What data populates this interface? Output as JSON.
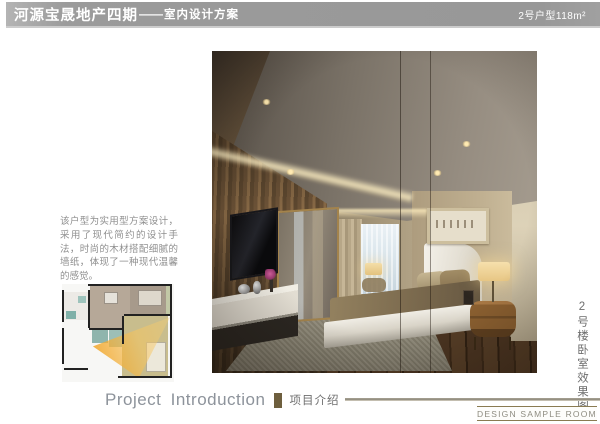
{
  "header": {
    "project_title": "河源宝晟地产四期",
    "divider": "——",
    "doc_type": "室内设计方案",
    "unit_label": "2号户型118m²"
  },
  "intro": {
    "paragraph": "该户型为实用型方案设计，采用了现代简约的设计手法，时尚的木材搭配细腻的墙纸，体现了一种现代温馨的感觉。"
  },
  "photo": {
    "caption_vertical": "2号楼卧室效果图",
    "subject": "bedroom-rendering"
  },
  "footer": {
    "section_en": "Project Introduction",
    "section_zh": "项目介绍",
    "stamp": "DESIGN SAMPLE ROOM"
  },
  "colors": {
    "header_bar": "#9b9b9b",
    "accent_bronze": "#6e5f3e",
    "stamp_border": "#8a7b52",
    "view_cone_orange": "#f09e1a",
    "text_gray": "#8f8f8f"
  }
}
